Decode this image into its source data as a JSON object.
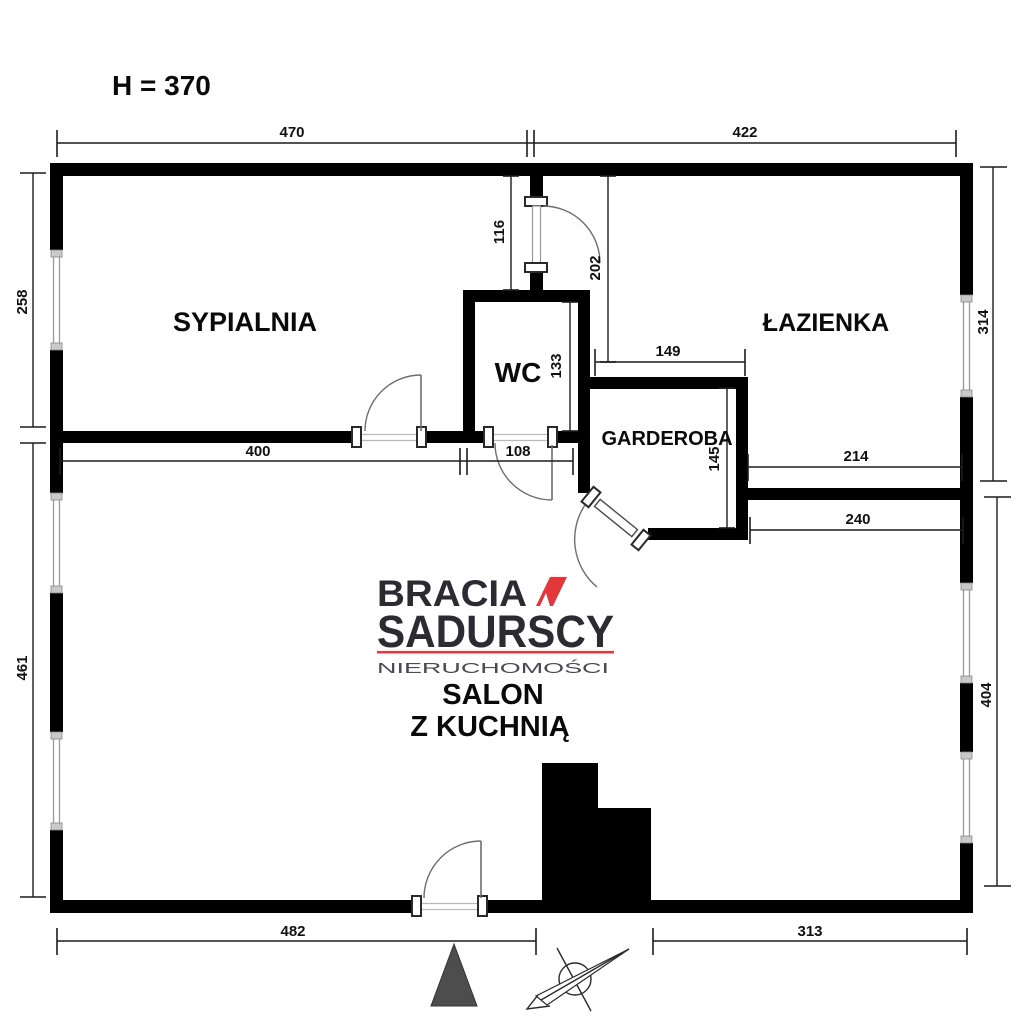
{
  "plan": {
    "ceiling_height": "H = 370",
    "rooms": {
      "bedroom": "SYPIALNIA",
      "bathroom": "ŁAZIENKA",
      "wc": "WC",
      "wardrobe": "GARDEROBA",
      "living_line1": "SALON",
      "living_line2": "Z KUCHNIĄ"
    },
    "dims": {
      "top_left": "470",
      "top_right": "422",
      "left_upper": "258",
      "left_lower": "461",
      "right_upper": "314",
      "right_lower": "404",
      "hall_width": "116",
      "hall_depth": "202",
      "wc_depth": "133",
      "wc_door": "108",
      "bedroom_width": "400",
      "wardrobe_width": "149",
      "wardrobe_depth": "145",
      "bath_wall": "214",
      "living_wall_right": "240",
      "bottom_left": "482",
      "bottom_right": "313"
    }
  },
  "logo": {
    "brand_line1": "BRACIA",
    "brand_line2": "SADURSCY",
    "tagline": "NIERUCHOMOŚCI"
  },
  "colors": {
    "wall": "#000000",
    "logo_red": "#e2373b",
    "logo_dark": "#2b2b31",
    "tagline_gray": "#4a4a50",
    "north_triangle": "#4d4d4d"
  }
}
